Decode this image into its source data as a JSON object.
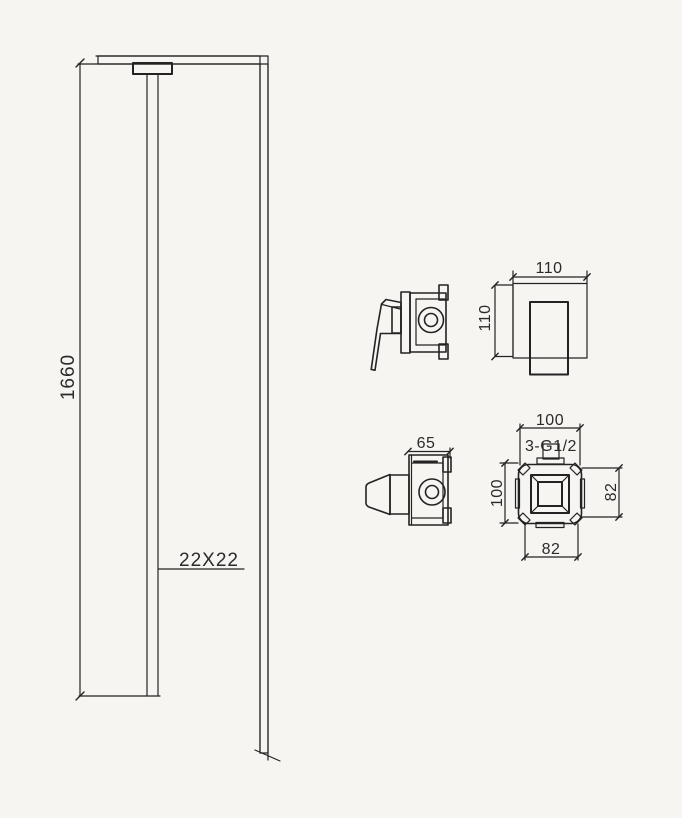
{
  "colors": {
    "background": "#f6f5f2",
    "line": "#232323",
    "text": "#2a2a2a"
  },
  "column_view": {
    "height_label": "1660",
    "pipe_section_label": "22X22"
  },
  "mixer_front_view": {
    "width_label": "110",
    "height_label": "110"
  },
  "diverter_side_view": {
    "depth_label": "65"
  },
  "plate_view": {
    "width_label": "100",
    "height_label": "100",
    "right_spacing_label": "82",
    "bottom_spacing_label": "82",
    "thread_label": "3-G1/2"
  }
}
